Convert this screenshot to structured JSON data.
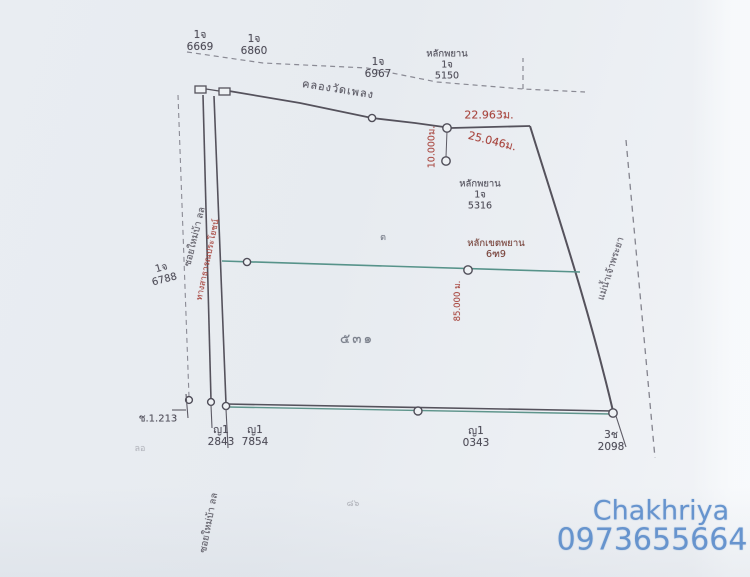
{
  "survey": {
    "top_markers": [
      {
        "type": "1จ",
        "number": "6669"
      },
      {
        "type": "1จ",
        "number": "6860"
      },
      {
        "type": "1จ",
        "number": "6967"
      }
    ],
    "witness_top": {
      "title": "หลักพยาน",
      "type": "1จ",
      "number": "5150"
    },
    "canal_name": "คลองวัดเพลง",
    "measurements": {
      "top_edge": "22.963ม.",
      "diagonal": "25.046ม.",
      "vertical_tie": "10.000ม.",
      "middle_line": "85.000 ม."
    },
    "witness_mid": {
      "title": "หลักพยาน",
      "type": "1จ",
      "number": "5316"
    },
    "boundary_stone": {
      "title": "หลักเขตพยาน",
      "number": "6ฑ9"
    },
    "left_marker": {
      "type": "1จ",
      "number": "6788"
    },
    "small_note": "ต",
    "parcel_number": "๕๓๑",
    "ref_point": "ช.1.213",
    "road_name_upper": "ซอยใหม่บ้า ลล",
    "road_label_red": "ทางสาธารณประโยชน์",
    "road_name_lower": "ซอยใหม่บ้า ลล",
    "river_name": "แม่น้ำเจ้าพระยา",
    "bottom_markers": [
      {
        "type": "ญ1",
        "number": "2843"
      },
      {
        "type": "ญ1",
        "number": "7854"
      },
      {
        "type": "ญ1",
        "number": "0343"
      },
      {
        "type": "3ช",
        "number": "2098"
      }
    ],
    "faint_mark_left": "ลอ",
    "faint_mark_bottom": "๘๖"
  },
  "watermark": {
    "name": "Chakhriya",
    "phone": "0973655664",
    "color": "#5c8dcb"
  },
  "colors": {
    "ink": "#55525c",
    "red": "#a8453e",
    "teal": "#57938a",
    "watermark_blue": "#5c8dcb"
  }
}
